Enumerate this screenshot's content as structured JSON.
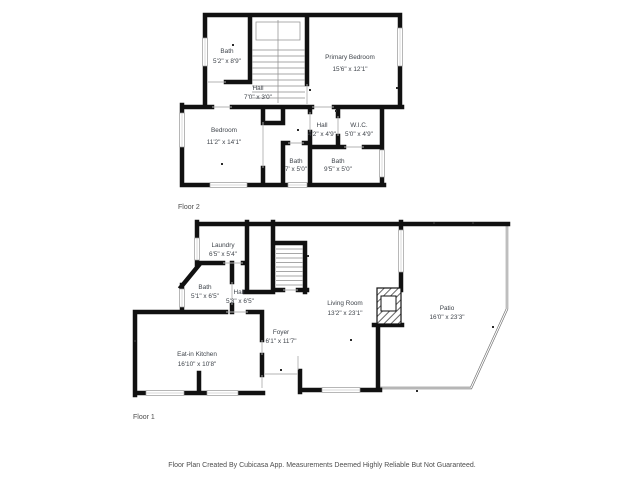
{
  "footer": {
    "text": "Floor Plan Created By Cubicasa App. Measurements Deemed Highly Reliable But Not Guaranteed."
  },
  "floor2": {
    "label": "Floor 2",
    "rooms": {
      "bath_upper": {
        "name": "Bath",
        "dims": "5'2\" x 8'9\""
      },
      "hall_upper": {
        "name": "Hall",
        "dims": "7'0\" x 3'0\""
      },
      "primary_bedroom": {
        "name": "Primary Bedroom",
        "dims": "15'6\" x 12'1\""
      },
      "bedroom": {
        "name": "Bedroom",
        "dims": "11'2\" x 14'1\""
      },
      "hall_lower": {
        "name": "Hall",
        "dims": "4'2\" x 4'9\""
      },
      "wic": {
        "name": "W.I.C.",
        "dims": "5'0\" x 4'9\""
      },
      "bath_small": {
        "name": "Bath",
        "dims": "7' x 5'0\""
      },
      "bath_right": {
        "name": "Bath",
        "dims": "9'5\" x 5'0\""
      }
    }
  },
  "floor1": {
    "label": "Floor 1",
    "rooms": {
      "laundry": {
        "name": "Laundry",
        "dims": "6'5\" x 5'4\""
      },
      "bath": {
        "name": "Bath",
        "dims": "5'1\" x 6'5\""
      },
      "hall": {
        "name": "Hall",
        "dims": "5'3\" x 6'5\""
      },
      "living_room": {
        "name": "Living Room",
        "dims": "13'2\" x 23'1\""
      },
      "foyer": {
        "name": "Foyer",
        "dims": "6'1\" x 11'7\""
      },
      "eat_in_kitchen": {
        "name": "Eat-in Kitchen",
        "dims": "16'10\" x 10'8\""
      },
      "patio": {
        "name": "Patio",
        "dims": "16'0\" x 23'3\""
      }
    }
  },
  "colors": {
    "wall": "#111111",
    "stair_lines": "#8a8a8a",
    "window_lines": "#9a9a9a",
    "room_text": "#3f444b",
    "muted_text": "#4d4d4d",
    "background": "#ffffff"
  }
}
